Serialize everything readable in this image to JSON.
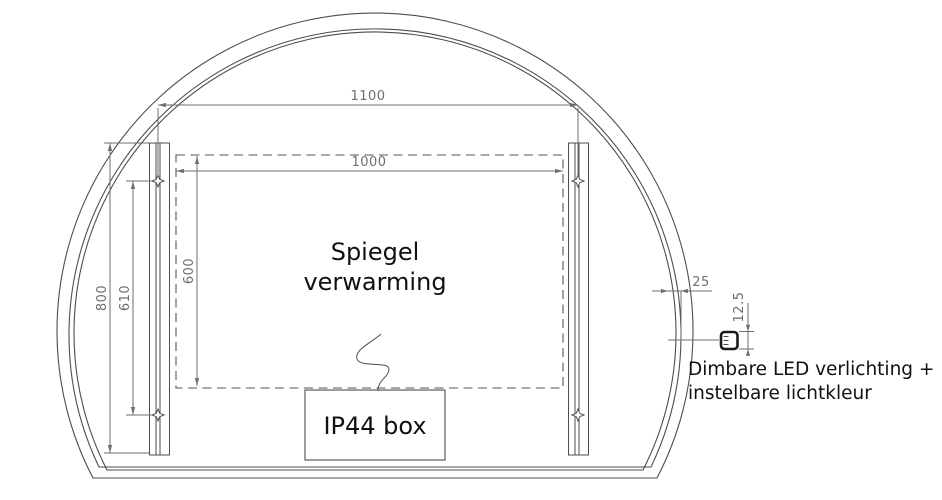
{
  "mirror": {
    "heating_label": [
      "Spiegel",
      "verwarming"
    ],
    "junction_box_label": "IP44 box",
    "led_note": [
      "Dimbare LED verlichting +",
      "instelbare lichtkleur"
    ]
  },
  "dimensions": {
    "overall_width": "1100",
    "heating_width": "1000",
    "heating_height": "600",
    "strip_length": "800",
    "hole_spacing": "610",
    "led_inset": "25",
    "led_profile_height": "12.5"
  },
  "colors": {
    "line": "#4d4d4d",
    "dimension": "#6e6e6e",
    "label": "#111111",
    "background": "#ffffff"
  }
}
